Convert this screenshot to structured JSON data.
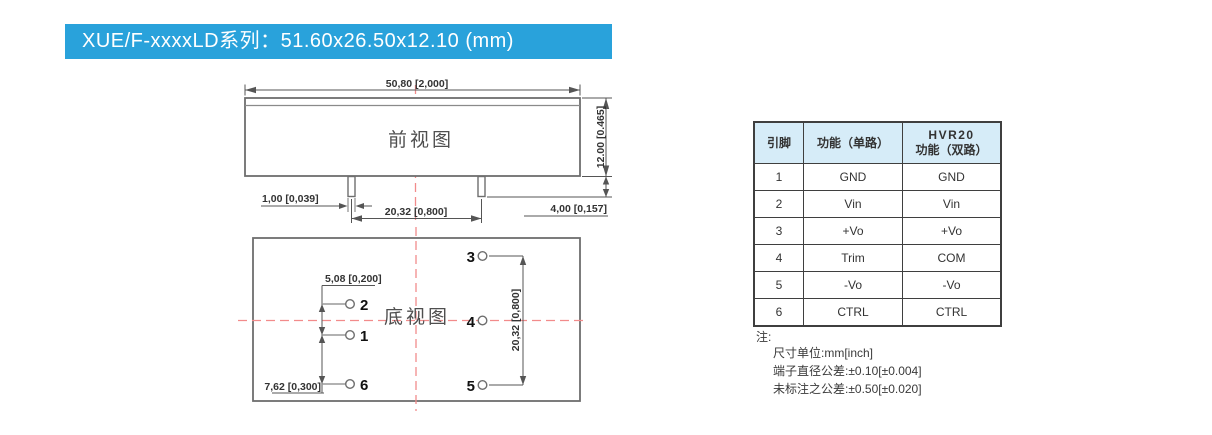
{
  "banner": {
    "title": "XUE/F-xxxxLD系列：51.60x26.50x12.10 (mm)"
  },
  "front_view": {
    "label": "前视图",
    "dim_width": "50,80 [2,000]",
    "dim_height": "12.00 [0.465]",
    "dim_pin_width": "1,00 [0,039]",
    "dim_pin_pitch": "20,32 [0,800]",
    "dim_pin_length": "4,00 [0,157]"
  },
  "bottom_view": {
    "label": "底视图",
    "dim_pitch_2_1": "5,08 [0,200]",
    "dim_pitch_1_6": "7,62 [0,300]",
    "dim_pitch_3_5": "20,32 [0,800]",
    "pin_labels_left": [
      "2",
      "1",
      "6"
    ],
    "pin_labels_right": [
      "3",
      "4",
      "5"
    ]
  },
  "pin_table": {
    "header_pin": "引脚",
    "header_single": "功能（单路）",
    "header_dual_line1": "HVR20",
    "header_dual_line2": "功能（双路）",
    "rows": [
      [
        "1",
        "GND",
        "GND"
      ],
      [
        "2",
        "Vin",
        "Vin"
      ],
      [
        "3",
        "+Vo",
        "+Vo"
      ],
      [
        "4",
        "Trim",
        "COM"
      ],
      [
        "5",
        "-Vo",
        "-Vo"
      ],
      [
        "6",
        "CTRL",
        "CTRL"
      ]
    ]
  },
  "notes": {
    "label": "注:",
    "lines": [
      "尺寸单位:mm[inch]",
      "端子直径公差:±0.10[±0.004]",
      "未标注之公差:±0.50[±0.020]"
    ]
  },
  "colors": {
    "banner_blue": "#29a2db",
    "table_header_bg": "#d6ecf8",
    "centerline_red": "#f28b8b",
    "line_gray": "#6e6e6e"
  }
}
